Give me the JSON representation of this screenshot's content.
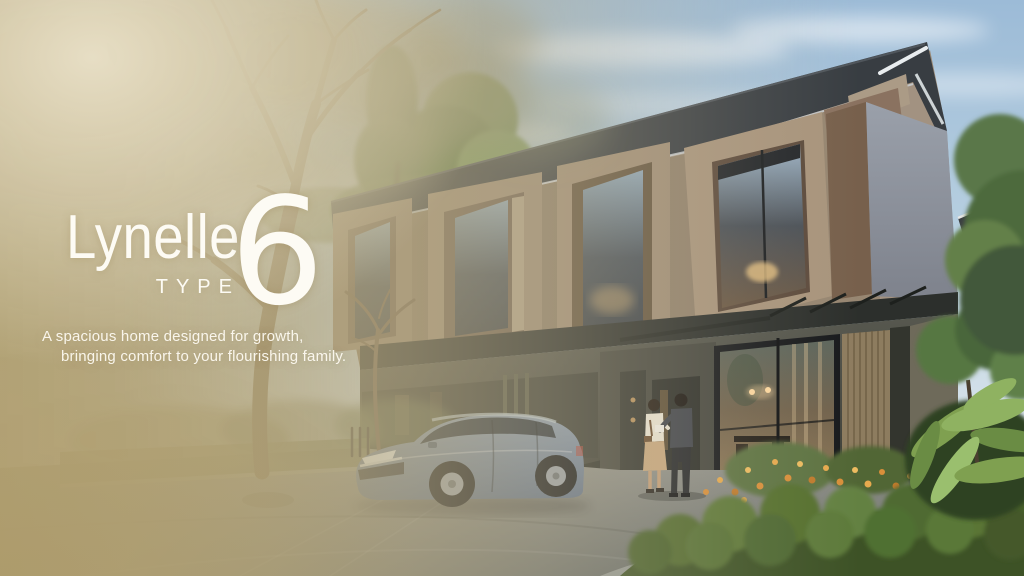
{
  "hero": {
    "title": "Lynelle",
    "type_label": "TYPE",
    "type_number": "6",
    "tagline": [
      "A spacious home designed for growth,",
      "bringing comfort to your flourishing family."
    ]
  },
  "scene": {
    "subject": "photorealistic render of a modern two-storey townhouse exterior",
    "elements": [
      "sky",
      "clouds",
      "trees",
      "townhouse-facade",
      "gable-roof",
      "window-frame-boxes",
      "canopy",
      "glass-entrance",
      "interior-dining-glimpse",
      "driveway",
      "parked-suv",
      "couple-standing",
      "flower-bed",
      "hedge",
      "tropical-plants",
      "foreground-tree",
      "golden-haze-overlay"
    ],
    "colors": {
      "overlay_gold": "#b5a67d",
      "text": "#fdfbf4",
      "sky_top": "#9cbbd7",
      "sky_horizon": "#e6ebee",
      "roof": "#383d42",
      "facade_brown": "#9a8872",
      "facade_gray": "#8d919b",
      "ground_floor": "#45463f",
      "foliage": "#5d7a4f",
      "flowers": "#d98f3a",
      "car": "#6b7d98",
      "driveway": "#85888a"
    }
  }
}
